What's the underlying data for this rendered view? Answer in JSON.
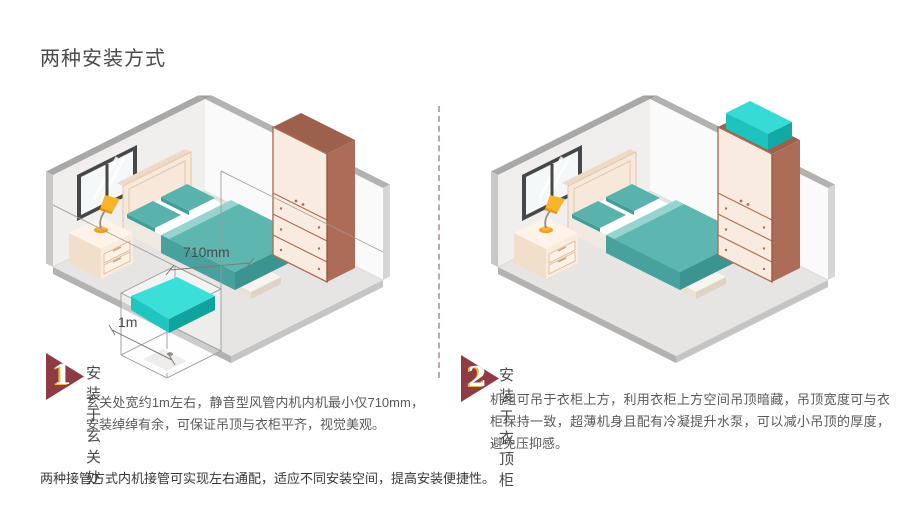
{
  "page": {
    "title": "两种安装方式",
    "footer_note": "两种接管方式内机接管可实现左右通配，适应不同安装空间，提高安装便捷性。"
  },
  "sections": [
    {
      "number": "1",
      "heading": "安装于玄关处",
      "body": "玄关处宽约1m左右，静音型风管内机内机最小仅710mm，安装绰绰有余，可保证吊顶与衣柜平齐，视觉美观。",
      "labels": {
        "width": "710mm",
        "depth": "1m"
      }
    },
    {
      "number": "2",
      "heading": "安装于衣顶柜",
      "body": "机组可吊于衣柜上方，利用衣柜上方空间吊顶暗藏，吊顶宽度可与衣柜保持一致，超薄机身且配有冷凝提升水泵，可以减小吊顶的厚度，避免压抑感。"
    }
  ],
  "colors": {
    "badge": "#8e3b44",
    "badge_number_shadow": "#e9b83c",
    "unit_cyan_top": "#3adfd8",
    "wardrobe_front": "#f9ebdf",
    "wardrobe_side": "#ac6c58",
    "bedding_teal": "#5eb6b1",
    "divider_dash": "#b9abab"
  }
}
